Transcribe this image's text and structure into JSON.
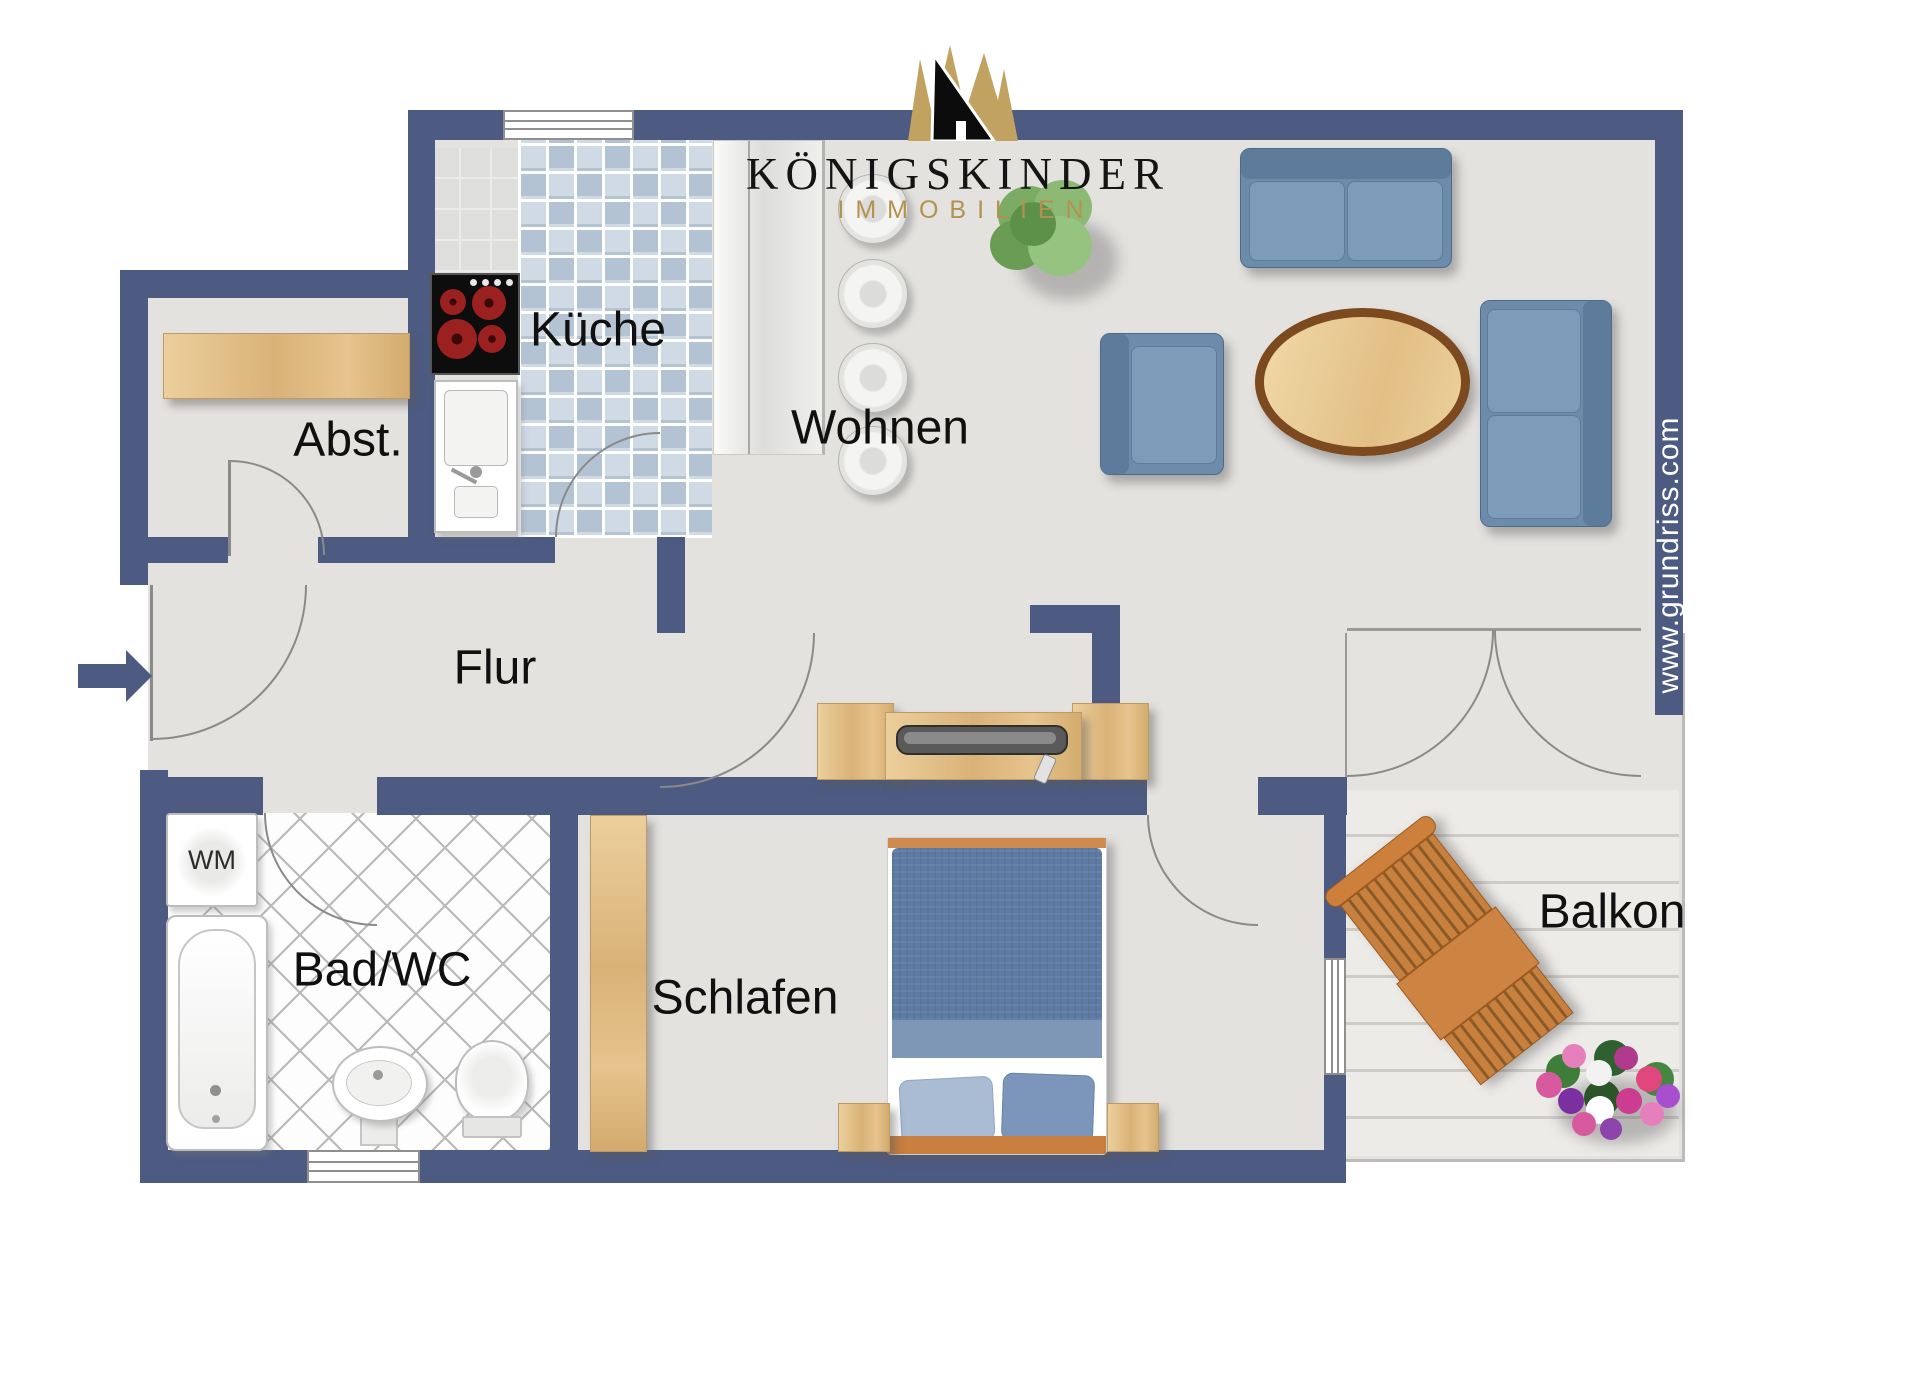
{
  "logo": {
    "title": "KÖNIGSKINDER",
    "subtitle": "IMMOBILIEN"
  },
  "watermark": "www.grundriss.com",
  "rooms": {
    "kueche": "Küche",
    "abst": "Abst.",
    "flur": "Flur",
    "wohnen": "Wohnen",
    "schlafen": "Schlafen",
    "bad": "Bad/WC",
    "balkon": "Balkon"
  },
  "appliances": {
    "washing_machine": "WM"
  },
  "colors": {
    "wall": "#4d5a82",
    "floor": "#e3e2df",
    "kitchen_tile": "#b4c3d3",
    "sofa_blue": "#6d8cab",
    "bed_blue": "#5d7ba3",
    "wood": "#d9b277",
    "balcony_wood": "#cd8443",
    "logo_gold": "#b3924f",
    "logo_black": "#0c0c0c"
  }
}
